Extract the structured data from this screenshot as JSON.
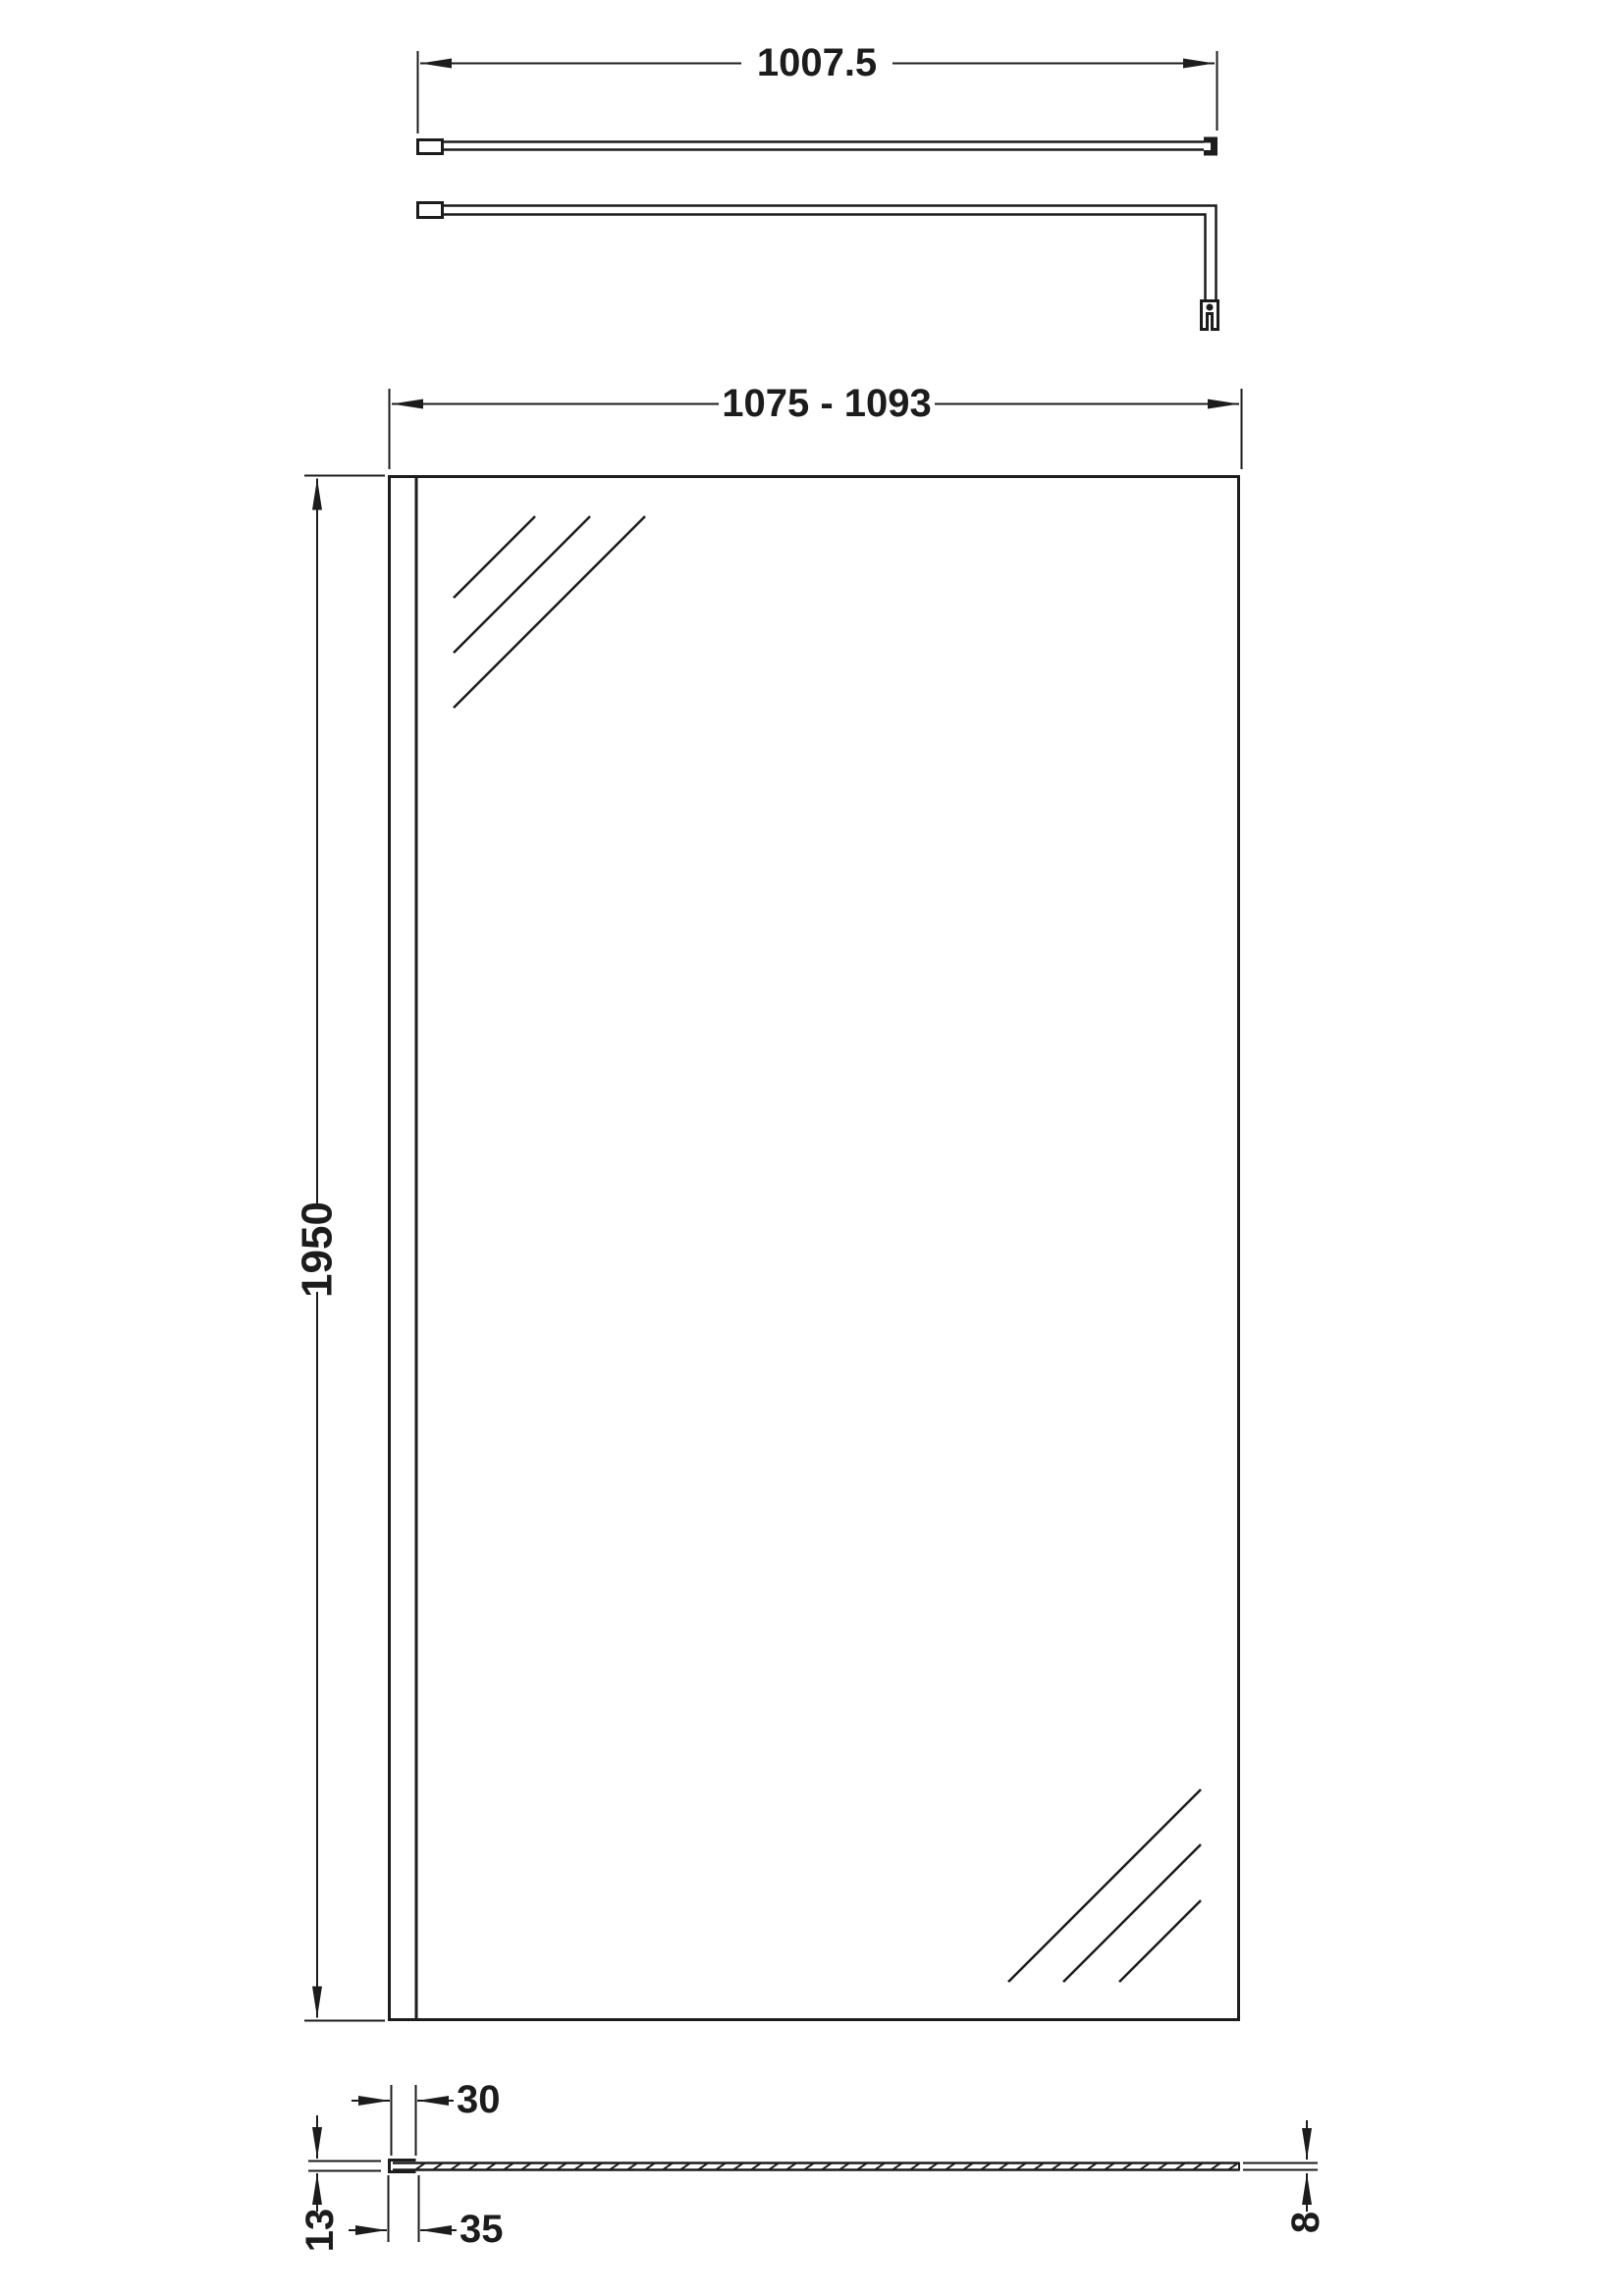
{
  "drawing": {
    "type": "technical-dimension-drawing",
    "subject": "walk-in shower screen with wall profile and support bar",
    "background_color": "#ffffff",
    "line_color": "#1c1c1c",
    "views": {
      "support_bar_plan": {
        "name": "support bar - plan view",
        "bar_length_label": "1007.5"
      },
      "support_bar_side": {
        "name": "support bar - side view with glass clamp"
      },
      "front": {
        "name": "front elevation of screen",
        "overall_width_label": "1075 - 1093",
        "height_label": "1950"
      },
      "section": {
        "name": "horizontal cross-section",
        "wall_profile_inner_width_label": "30",
        "wall_profile_depth_label": "13",
        "wall_profile_overall_width_label": "35",
        "glass_thickness_label": "8"
      }
    }
  }
}
